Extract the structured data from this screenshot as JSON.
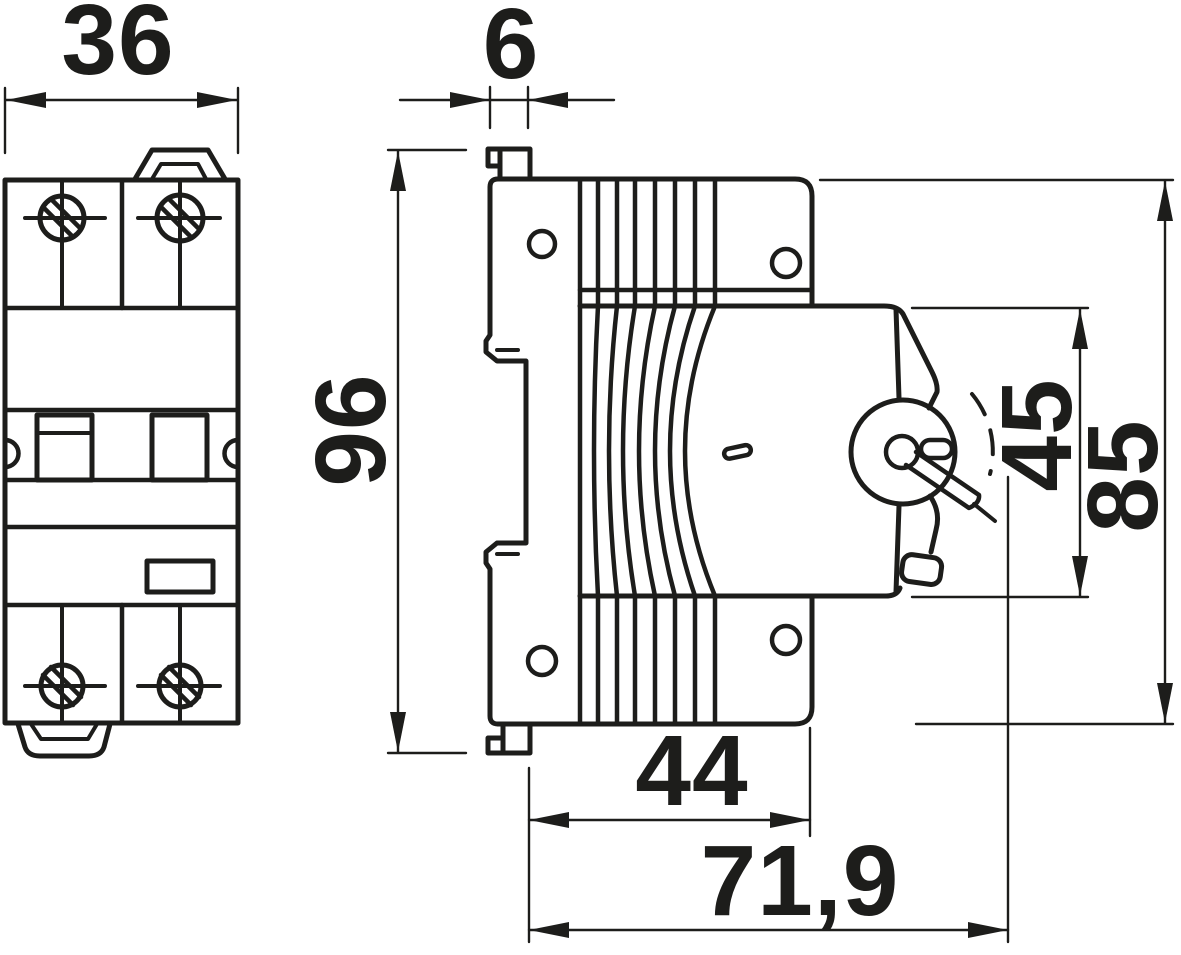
{
  "drawing_type": "technical dimension drawing - DIN rail circuit breaker, front and side views",
  "dimensions": {
    "front_width_mm": "36",
    "rail_clip_depth_mm": "6",
    "total_height_mm": "96",
    "body_depth_mm": "44",
    "total_depth_mm": "71,9",
    "front_face_height_mm": "45",
    "mounting_height_mm": "85"
  },
  "colors": {
    "line": "#1d1d1b",
    "background": "#ffffff"
  }
}
